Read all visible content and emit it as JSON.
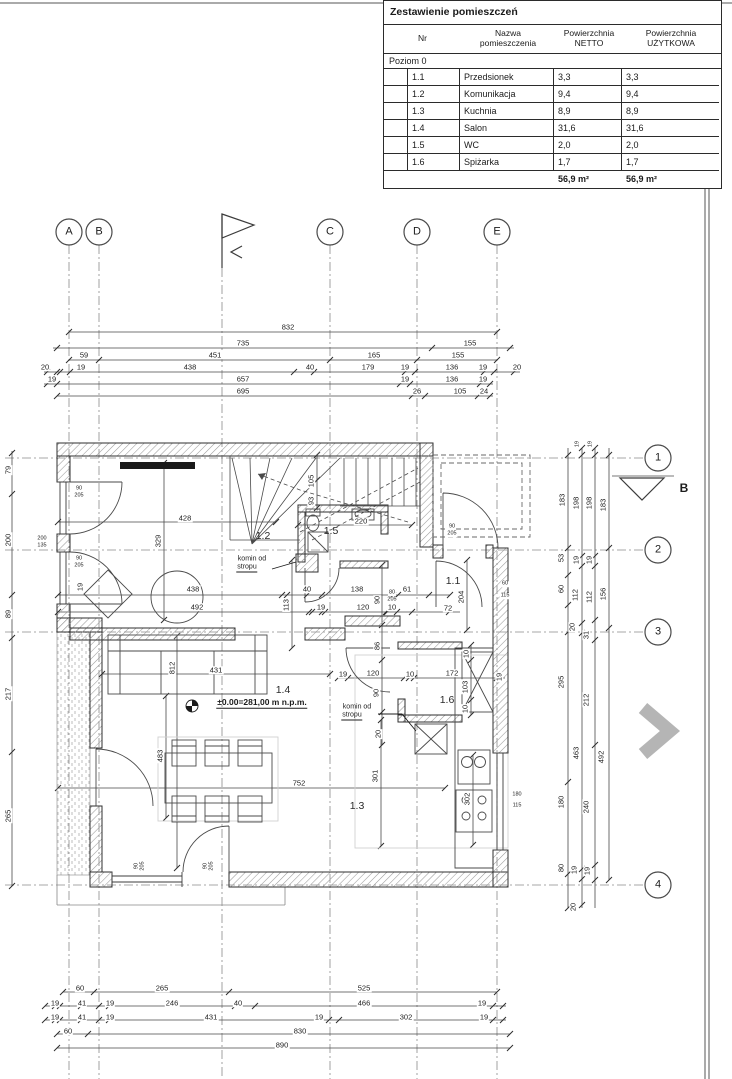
{
  "table": {
    "title": "Zestawienie pomieszczeń",
    "col_headers": [
      "Nr",
      "Nazwa\npomieszczenia",
      "Powierzchnia\nNETTO",
      "Powierzchnia\nUŻYTKOWA"
    ],
    "section": "Poziom 0",
    "rows": [
      {
        "nr": "1.1",
        "name": "Przedsionek",
        "netto": "3,3",
        "uzytkowa": "3,3"
      },
      {
        "nr": "1.2",
        "name": "Komunikacja",
        "netto": "9,4",
        "uzytkowa": "9,4"
      },
      {
        "nr": "1.3",
        "name": "Kuchnia",
        "netto": "8,9",
        "uzytkowa": "8,9"
      },
      {
        "nr": "1.4",
        "name": "Salon",
        "netto": "31,6",
        "uzytkowa": "31,6"
      },
      {
        "nr": "1.5",
        "name": "WC",
        "netto": "2,0",
        "uzytkowa": "2,0"
      },
      {
        "nr": "1.6",
        "name": "Spiżarka",
        "netto": "1,7",
        "uzytkowa": "1,7"
      }
    ],
    "total_netto": "56,9 m²",
    "total_uzytkowa": "56,9 m²"
  },
  "grid": {
    "top": [
      {
        "t": "A",
        "x": 69,
        "y": 232
      },
      {
        "t": "B",
        "x": 99,
        "y": 232
      },
      {
        "t": "C",
        "x": 330,
        "y": 232
      },
      {
        "t": "D",
        "x": 417,
        "y": 232
      },
      {
        "t": "E",
        "x": 497,
        "y": 232
      }
    ],
    "right": [
      {
        "t": "1",
        "x": 658,
        "y": 458
      },
      {
        "t": "2",
        "x": 658,
        "y": 550
      },
      {
        "t": "3",
        "x": 658,
        "y": 632
      },
      {
        "t": "4",
        "x": 658,
        "y": 885
      }
    ],
    "markers": [
      {
        "t": "B",
        "x": 684,
        "y": 488,
        "c": "sec"
      }
    ]
  },
  "plan": {
    "rooms": [
      {
        "t": "1.1",
        "x": 453,
        "y": 581
      },
      {
        "t": "1.2",
        "x": 263,
        "y": 536
      },
      {
        "t": "1.3",
        "x": 357,
        "y": 806
      },
      {
        "t": "1.4",
        "x": 283,
        "y": 690
      },
      {
        "t": "1.5",
        "x": 331,
        "y": 531
      },
      {
        "t": "1.6",
        "x": 447,
        "y": 700
      }
    ],
    "annotations": [
      {
        "t": "komin od",
        "x": 252,
        "y": 559,
        "c": "ann"
      },
      {
        "t": "stropu",
        "x": 247,
        "y": 568,
        "c": "ann und"
      },
      {
        "t": "komin od",
        "x": 357,
        "y": 707,
        "c": "ann"
      },
      {
        "t": "stropu",
        "x": 352,
        "y": 716,
        "c": "ann und"
      },
      {
        "t": "±0.00=281,00 m n.p.m.",
        "x": 262,
        "y": 703,
        "c": "elev und"
      }
    ]
  },
  "dims": {
    "top": [
      {
        "t": "832",
        "x": 288,
        "y": 327
      },
      {
        "t": "735",
        "x": 243,
        "y": 343
      },
      {
        "t": "155",
        "x": 470,
        "y": 343
      },
      {
        "t": "59",
        "x": 84,
        "y": 355
      },
      {
        "t": "451",
        "x": 215,
        "y": 355
      },
      {
        "t": "165",
        "x": 374,
        "y": 355
      },
      {
        "t": "155",
        "x": 458,
        "y": 355
      },
      {
        "t": "20",
        "x": 45,
        "y": 367
      },
      {
        "t": "19",
        "x": 81,
        "y": 367
      },
      {
        "t": "438",
        "x": 190,
        "y": 367
      },
      {
        "t": "40",
        "x": 310,
        "y": 367
      },
      {
        "t": "179",
        "x": 368,
        "y": 367
      },
      {
        "t": "19",
        "x": 405,
        "y": 367
      },
      {
        "t": "136",
        "x": 452,
        "y": 367
      },
      {
        "t": "19",
        "x": 483,
        "y": 367
      },
      {
        "t": "20",
        "x": 517,
        "y": 367
      },
      {
        "t": "19",
        "x": 52,
        "y": 379
      },
      {
        "t": "657",
        "x": 243,
        "y": 379
      },
      {
        "t": "19",
        "x": 405,
        "y": 379
      },
      {
        "t": "136",
        "x": 452,
        "y": 379
      },
      {
        "t": "19",
        "x": 483,
        "y": 379
      },
      {
        "t": "695",
        "x": 243,
        "y": 391
      },
      {
        "t": "26",
        "x": 417,
        "y": 391
      },
      {
        "t": "105",
        "x": 460,
        "y": 391
      },
      {
        "t": "24",
        "x": 484,
        "y": 391
      }
    ],
    "bottom": [
      {
        "t": "60",
        "x": 80,
        "y": 988
      },
      {
        "t": "265",
        "x": 162,
        "y": 988
      },
      {
        "t": "525",
        "x": 364,
        "y": 988
      },
      {
        "t": "19",
        "x": 55,
        "y": 1003
      },
      {
        "t": "41",
        "x": 82,
        "y": 1003
      },
      {
        "t": "19",
        "x": 110,
        "y": 1003
      },
      {
        "t": "246",
        "x": 172,
        "y": 1003
      },
      {
        "t": "40",
        "x": 238,
        "y": 1003
      },
      {
        "t": "466",
        "x": 364,
        "y": 1003
      },
      {
        "t": "19",
        "x": 482,
        "y": 1003
      },
      {
        "t": "19",
        "x": 55,
        "y": 1017
      },
      {
        "t": "41",
        "x": 82,
        "y": 1017
      },
      {
        "t": "19",
        "x": 110,
        "y": 1017
      },
      {
        "t": "431",
        "x": 211,
        "y": 1017
      },
      {
        "t": "19",
        "x": 319,
        "y": 1017
      },
      {
        "t": "302",
        "x": 406,
        "y": 1017
      },
      {
        "t": "19",
        "x": 484,
        "y": 1017
      },
      {
        "t": "60",
        "x": 68,
        "y": 1031
      },
      {
        "t": "830",
        "x": 300,
        "y": 1031
      },
      {
        "t": "890",
        "x": 282,
        "y": 1045
      }
    ],
    "left": [
      {
        "t": "79",
        "x": 8,
        "y": 470,
        "r": 1
      },
      {
        "t": "200",
        "x": 8,
        "y": 540,
        "r": 1
      },
      {
        "t": "89",
        "x": 8,
        "y": 614,
        "r": 1
      },
      {
        "t": "217",
        "x": 8,
        "y": 694,
        "r": 1
      },
      {
        "t": "265",
        "x": 8,
        "y": 816,
        "r": 1
      },
      {
        "t": "200",
        "x": 42,
        "y": 539,
        "s": 1
      },
      {
        "t": "135",
        "x": 42,
        "y": 546,
        "s": 1
      }
    ],
    "right": [
      {
        "t": "19",
        "x": 578,
        "y": 444,
        "r": 1,
        "s": 1
      },
      {
        "t": "19",
        "x": 591,
        "y": 444,
        "r": 1,
        "s": 1
      },
      {
        "t": "183",
        "x": 562,
        "y": 500,
        "r": 1
      },
      {
        "t": "198",
        "x": 576,
        "y": 503,
        "r": 1
      },
      {
        "t": "198",
        "x": 589,
        "y": 503,
        "r": 1
      },
      {
        "t": "183",
        "x": 603,
        "y": 505,
        "r": 1
      },
      {
        "t": "53",
        "x": 561,
        "y": 558,
        "r": 1
      },
      {
        "t": "19",
        "x": 576,
        "y": 560,
        "r": 1
      },
      {
        "t": "19",
        "x": 589,
        "y": 560,
        "r": 1
      },
      {
        "t": "60",
        "x": 561,
        "y": 589,
        "r": 1
      },
      {
        "t": "112",
        "x": 575,
        "y": 595,
        "r": 1
      },
      {
        "t": "112",
        "x": 589,
        "y": 597,
        "r": 1
      },
      {
        "t": "156",
        "x": 603,
        "y": 594,
        "r": 1
      },
      {
        "t": "20",
        "x": 572,
        "y": 627,
        "r": 1
      },
      {
        "t": "31",
        "x": 586,
        "y": 635,
        "r": 1
      },
      {
        "t": "295",
        "x": 561,
        "y": 682,
        "r": 1
      },
      {
        "t": "212",
        "x": 586,
        "y": 700,
        "r": 1
      },
      {
        "t": "463",
        "x": 576,
        "y": 753,
        "r": 1
      },
      {
        "t": "492",
        "x": 601,
        "y": 757,
        "r": 1
      },
      {
        "t": "180",
        "x": 561,
        "y": 802,
        "r": 1
      },
      {
        "t": "240",
        "x": 586,
        "y": 807,
        "r": 1
      },
      {
        "t": "80",
        "x": 561,
        "y": 868,
        "r": 1
      },
      {
        "t": "19",
        "x": 574,
        "y": 870,
        "r": 1
      },
      {
        "t": "19",
        "x": 587,
        "y": 871,
        "r": 1
      },
      {
        "t": "20",
        "x": 573,
        "y": 907,
        "r": 1
      }
    ],
    "interior": [
      {
        "t": "428",
        "x": 185,
        "y": 518
      },
      {
        "t": "329",
        "x": 158,
        "y": 541,
        "r": 1
      },
      {
        "t": "19",
        "x": 80,
        "y": 587,
        "r": 1
      },
      {
        "t": "438",
        "x": 193,
        "y": 589
      },
      {
        "t": "492",
        "x": 197,
        "y": 607
      },
      {
        "t": "220",
        "x": 361,
        "y": 521
      },
      {
        "t": "40",
        "x": 307,
        "y": 589
      },
      {
        "t": "138",
        "x": 357,
        "y": 589
      },
      {
        "t": "61",
        "x": 407,
        "y": 589
      },
      {
        "t": "19",
        "x": 321,
        "y": 607
      },
      {
        "t": "120",
        "x": 363,
        "y": 607
      },
      {
        "t": "10",
        "x": 392,
        "y": 607
      },
      {
        "t": "72",
        "x": 448,
        "y": 608
      },
      {
        "t": "204",
        "x": 461,
        "y": 597,
        "r": 1
      },
      {
        "t": "113",
        "x": 286,
        "y": 605,
        "r": 1
      },
      {
        "t": "90",
        "x": 377,
        "y": 600,
        "r": 1
      },
      {
        "t": "80",
        "x": 392,
        "y": 593,
        "s": 1
      },
      {
        "t": "205",
        "x": 392,
        "y": 600,
        "s": 1
      },
      {
        "t": "105",
        "x": 311,
        "y": 481,
        "r": 1
      },
      {
        "t": "93",
        "x": 311,
        "y": 501,
        "r": 1
      },
      {
        "t": "86",
        "x": 377,
        "y": 646,
        "r": 1
      },
      {
        "t": "19",
        "x": 343,
        "y": 674
      },
      {
        "t": "120",
        "x": 373,
        "y": 673
      },
      {
        "t": "10",
        "x": 410,
        "y": 674
      },
      {
        "t": "172",
        "x": 452,
        "y": 673
      },
      {
        "t": "19",
        "x": 499,
        "y": 677,
        "r": 1
      },
      {
        "t": "10",
        "x": 466,
        "y": 654,
        "r": 1
      },
      {
        "t": "103",
        "x": 465,
        "y": 687,
        "r": 1
      },
      {
        "t": "10",
        "x": 465,
        "y": 709,
        "r": 1
      },
      {
        "t": "90",
        "x": 376,
        "y": 693,
        "r": 1
      },
      {
        "t": "20",
        "x": 378,
        "y": 734,
        "r": 1
      },
      {
        "t": "301",
        "x": 375,
        "y": 776,
        "r": 1
      },
      {
        "t": "752",
        "x": 299,
        "y": 783
      },
      {
        "t": "302",
        "x": 467,
        "y": 799,
        "r": 1
      },
      {
        "t": "812",
        "x": 172,
        "y": 668,
        "r": 1
      },
      {
        "t": "431",
        "x": 216,
        "y": 670
      },
      {
        "t": "483",
        "x": 160,
        "y": 756,
        "r": 1
      },
      {
        "t": "180",
        "x": 517,
        "y": 795,
        "s": 1
      },
      {
        "t": "115",
        "x": 517,
        "y": 806,
        "s": 1
      },
      {
        "t": "60",
        "x": 505,
        "y": 584,
        "s": 1
      },
      {
        "t": "115",
        "x": 505,
        "y": 596,
        "s": 1
      },
      {
        "t": "90",
        "x": 137,
        "y": 866,
        "s": 1,
        "r": 1
      },
      {
        "t": "205",
        "x": 143,
        "y": 866,
        "s": 1,
        "r": 1
      },
      {
        "t": "90",
        "x": 206,
        "y": 866,
        "s": 1,
        "r": 1
      },
      {
        "t": "205",
        "x": 212,
        "y": 866,
        "s": 1,
        "r": 1
      },
      {
        "t": "90",
        "x": 452,
        "y": 527,
        "s": 1
      },
      {
        "t": "205",
        "x": 452,
        "y": 534,
        "s": 1
      },
      {
        "t": "90",
        "x": 79,
        "y": 489,
        "s": 1
      },
      {
        "t": "205",
        "x": 79,
        "y": 496,
        "s": 1
      },
      {
        "t": "90",
        "x": 79,
        "y": 559,
        "s": 1
      },
      {
        "t": "205",
        "x": 79,
        "y": 566,
        "s": 1
      }
    ]
  },
  "nav": {
    "next_arrow_icon": "chevron-right"
  }
}
